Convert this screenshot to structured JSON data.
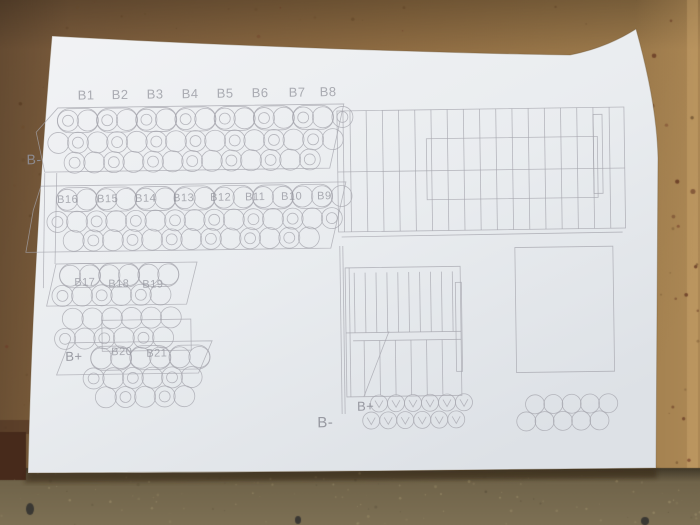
{
  "scene": {
    "board": {
      "base_left": "#75573a",
      "base_mid": "#8d6b42",
      "base_right": "#a2804f",
      "edge_light": "#b3905e",
      "speckle_colors": [
        "#5d4226",
        "#6b4a2a",
        "#53381f",
        "#6e3524"
      ]
    },
    "table": {
      "base_top": "#6c6047",
      "base_bottom": "#7d7054",
      "speckle_light": "#a3956f",
      "speckle_dark": "#554c38",
      "marks": [
        [
          30,
          509,
          4,
          6
        ],
        [
          298,
          520,
          3,
          4
        ],
        [
          645,
          521,
          4,
          4
        ]
      ]
    },
    "shadow_corner": "#472a1b",
    "paper": {
      "light": "#f2f3f5",
      "mid": "#e9ecef",
      "dark": "#dde1e6",
      "path": "M52,36 C230,46 440,53 570,55 C600,49 620,39 636,29 C648,72 657,115 658,158 L656,468 C460,470 210,473 28,473 C31,330 40,175 52,36 Z",
      "shadow_path": "M28,473 L656,468 L657,478 L24,483 Z"
    }
  },
  "drawing": {
    "stroke": "#a4a4ac",
    "stroke_width": 0.8,
    "label_color": "#8f9099",
    "rotation": "rotate(-0.8 340 260)",
    "polys": [
      {
        "g": "tv",
        "pts": [
          [
            60,
            104
          ],
          [
            346,
            104
          ],
          [
            331,
            168
          ],
          [
            46,
            168
          ],
          [
            38,
            128
          ]
        ]
      },
      {
        "g": "tv",
        "pts": [
          [
            42,
            182
          ],
          [
            347,
            182
          ],
          [
            331,
            248
          ],
          [
            26,
            248
          ],
          [
            34,
            206
          ]
        ]
      },
      {
        "g": "tv",
        "pts": [
          [
            56,
            260
          ],
          [
            197,
            260
          ],
          [
            186,
            302
          ],
          [
            46,
            302
          ]
        ]
      },
      {
        "g": "tv",
        "pts": [
          [
            68,
            339
          ],
          [
            211,
            339
          ],
          [
            197,
            371
          ],
          [
            55,
            371
          ]
        ]
      }
    ],
    "rects": [
      {
        "g": "tv",
        "x": 101,
        "y": 317,
        "w": 89,
        "h": 31
      },
      {
        "g": "sv1",
        "x": 339,
        "y": 111,
        "w": 287,
        "h": 121
      },
      {
        "g": "sv1",
        "x": 428,
        "y": 140,
        "w": 171,
        "h": 61
      },
      {
        "g": "sv1",
        "x": 595,
        "y": 118,
        "w": 9,
        "h": 79
      },
      {
        "g": "sv2",
        "x": 345,
        "y": 268,
        "w": 115,
        "h": 129
      },
      {
        "g": "sv2",
        "x": 455,
        "y": 284,
        "w": 6,
        "h": 89
      },
      {
        "g": "r3",
        "x": 515,
        "y": 250,
        "w": 98,
        "h": 125
      }
    ],
    "lines": [
      {
        "g": "tv",
        "x1": 46,
        "y1": 169,
        "x2": 43,
        "y2": 284
      },
      {
        "g": "tv",
        "x1": 58,
        "y1": 169,
        "x2": 55,
        "y2": 260
      },
      {
        "g": "sv1",
        "x1": 345,
        "y1": 111,
        "x2": 345,
        "y2": 232
      },
      {
        "g": "sv1",
        "x1": 339,
        "y1": 172,
        "x2": 626,
        "y2": 172
      },
      {
        "g": "sv1",
        "x1": 342,
        "y1": 237,
        "x2": 623,
        "y2": 236
      },
      {
        "g": "sv2",
        "x1": 340,
        "y1": 246,
        "x2": 340,
        "y2": 414
      },
      {
        "g": "sv2",
        "x1": 343,
        "y1": 246,
        "x2": 343,
        "y2": 414
      },
      {
        "g": "sv2",
        "x1": 349,
        "y1": 268,
        "x2": 349,
        "y2": 397
      },
      {
        "g": "sv2",
        "x1": 345,
        "y1": 333,
        "x2": 460,
        "y2": 333
      },
      {
        "g": "sv2",
        "x1": 352,
        "y1": 341,
        "x2": 460,
        "y2": 341
      },
      {
        "g": "sv2",
        "x1": 388,
        "y1": 332,
        "x2": 362,
        "y2": 397
      }
    ],
    "stripes": [
      {
        "g": "sv1",
        "x0": 352,
        "step": 16.2,
        "count": 17,
        "y1": 111,
        "y2": 232
      },
      {
        "g": "sv2",
        "x0": 354,
        "step": 10.9,
        "count": 10,
        "y1": 273,
        "y2": 333
      },
      {
        "g": "sv2",
        "x0": 363,
        "step": 15.6,
        "count": 6,
        "y1": 341,
        "y2": 396
      }
    ],
    "pill_rows": [
      {
        "g": "tv",
        "cx0": 79.8,
        "step": 39.2,
        "count": 7,
        "cy": 117,
        "w": 41,
        "h": 24
      },
      {
        "g": "tv",
        "cx0": 77.8,
        "step": 39.2,
        "count": 7,
        "cy": 196,
        "w": 41,
        "h": 24
      },
      {
        "g": "tv",
        "cx0": 79.8,
        "step": 39.2,
        "count": 3,
        "cy": 272,
        "w": 41,
        "h": 24
      },
      {
        "g": "tv",
        "cx0": 109.8,
        "step": 39.2,
        "count": 3,
        "cy": 355,
        "w": 41,
        "h": 24
      }
    ],
    "circle_rows": [
      {
        "g": "tv",
        "cx0": 70,
        "step": 19.6,
        "count": 15,
        "cy": 117,
        "r": 10.5,
        "inner": "alt"
      },
      {
        "g": "tv",
        "cx0": 60,
        "step": 19.6,
        "count": 15,
        "cy": 139,
        "r": 10.5,
        "inner": "alt2"
      },
      {
        "g": "tv",
        "cx0": 76,
        "step": 19.6,
        "count": 13,
        "cy": 159,
        "r": 10.5,
        "inner": "alt"
      },
      {
        "g": "tv",
        "cx0": 68,
        "step": 19.6,
        "count": 15,
        "cy": 196,
        "r": 10.5,
        "inner": "none"
      },
      {
        "g": "tv",
        "cx0": 58,
        "step": 19.6,
        "count": 15,
        "cy": 218,
        "r": 10.5,
        "inner": "alt"
      },
      {
        "g": "tv",
        "cx0": 74,
        "step": 19.6,
        "count": 13,
        "cy": 237,
        "r": 10.5,
        "inner": "alt2"
      },
      {
        "g": "tv",
        "cx0": 70,
        "step": 19.6,
        "count": 6,
        "cy": 272,
        "r": 10.5,
        "inner": "none"
      },
      {
        "g": "tv",
        "cx0": 62,
        "step": 19.6,
        "count": 6,
        "cy": 292,
        "r": 10.5,
        "inner": "alt"
      },
      {
        "g": "tv",
        "cx0": 72,
        "step": 19.6,
        "count": 6,
        "cy": 315,
        "r": 10.5,
        "inner": "none"
      },
      {
        "g": "tv",
        "cx0": 64,
        "step": 19.6,
        "count": 6,
        "cy": 335,
        "r": 10.5,
        "inner": "alt"
      },
      {
        "g": "tv",
        "cx0": 100,
        "step": 19.6,
        "count": 6,
        "cy": 355,
        "r": 10.5,
        "inner": "none"
      },
      {
        "g": "tv",
        "cx0": 92,
        "step": 19.6,
        "count": 6,
        "cy": 375,
        "r": 10.5,
        "inner": "alt"
      },
      {
        "g": "tv",
        "cx0": 104,
        "step": 19.6,
        "count": 5,
        "cy": 394,
        "r": 10.5,
        "inner": "alt2"
      },
      {
        "g": "c1",
        "cx0": 377,
        "step": 17,
        "count": 6,
        "cy": 404,
        "r": 8.5,
        "inner": "none",
        "v": true
      },
      {
        "g": "c1",
        "cx0": 369,
        "step": 17,
        "count": 6,
        "cy": 421,
        "r": 8.5,
        "inner": "none",
        "v": true
      },
      {
        "g": "c2",
        "cx0": 533,
        "step": 18.3,
        "count": 5,
        "cy": 407,
        "r": 9.5,
        "inner": "none"
      },
      {
        "g": "c2",
        "cx0": 524,
        "step": 18.3,
        "count": 5,
        "cy": 424,
        "r": 9.5,
        "inner": "none"
      }
    ],
    "labels": [
      {
        "g": "lbl",
        "text": "B1",
        "x": 80,
        "y": 96,
        "size": 13
      },
      {
        "g": "lbl",
        "text": "B2",
        "x": 114,
        "y": 96,
        "size": 13
      },
      {
        "g": "lbl",
        "text": "B3",
        "x": 149,
        "y": 96,
        "size": 13
      },
      {
        "g": "lbl",
        "text": "B4",
        "x": 184,
        "y": 96,
        "size": 13
      },
      {
        "g": "lbl",
        "text": "B5",
        "x": 219,
        "y": 96,
        "size": 13
      },
      {
        "g": "lbl",
        "text": "B6",
        "x": 254,
        "y": 96,
        "size": 13
      },
      {
        "g": "lbl",
        "text": "B7",
        "x": 291,
        "y": 96,
        "size": 13
      },
      {
        "g": "lbl",
        "text": "B8",
        "x": 322,
        "y": 96,
        "size": 13
      },
      {
        "g": "lbl",
        "text": "B16",
        "x": 58,
        "y": 199,
        "size": 11
      },
      {
        "g": "lbl",
        "text": "B15",
        "x": 98,
        "y": 199,
        "size": 11
      },
      {
        "g": "lbl",
        "text": "B14",
        "x": 136,
        "y": 199,
        "size": 11
      },
      {
        "g": "lbl",
        "text": "B13",
        "x": 174,
        "y": 199,
        "size": 11
      },
      {
        "g": "lbl",
        "text": "B12",
        "x": 211,
        "y": 199,
        "size": 11
      },
      {
        "g": "lbl",
        "text": "B11",
        "x": 246,
        "y": 199,
        "size": 11
      },
      {
        "g": "lbl",
        "text": "B10",
        "x": 282,
        "y": 199,
        "size": 11
      },
      {
        "g": "lbl",
        "text": "B9",
        "x": 318,
        "y": 199,
        "size": 11
      },
      {
        "g": "lbl",
        "text": "B17",
        "x": 74,
        "y": 282,
        "size": 11
      },
      {
        "g": "lbl",
        "text": "B18",
        "x": 108,
        "y": 284,
        "size": 11
      },
      {
        "g": "lbl",
        "text": "B19",
        "x": 142,
        "y": 285,
        "size": 11
      },
      {
        "g": "lbl",
        "text": "B20",
        "x": 110,
        "y": 352,
        "size": 11
      },
      {
        "g": "lbl",
        "text": "B21",
        "x": 145,
        "y": 354,
        "size": 11
      },
      {
        "g": "lbl",
        "text": "B-",
        "x": 28,
        "y": 160,
        "size": 14,
        "em": true
      },
      {
        "g": "lbl",
        "text": "B+",
        "x": 64,
        "y": 357,
        "size": 13,
        "em": true
      },
      {
        "g": "lbl",
        "text": "B+",
        "x": 355,
        "y": 411,
        "size": 13,
        "em": true
      },
      {
        "g": "lbl",
        "text": "B-",
        "x": 315,
        "y": 427,
        "size": 15,
        "em": true
      }
    ]
  }
}
